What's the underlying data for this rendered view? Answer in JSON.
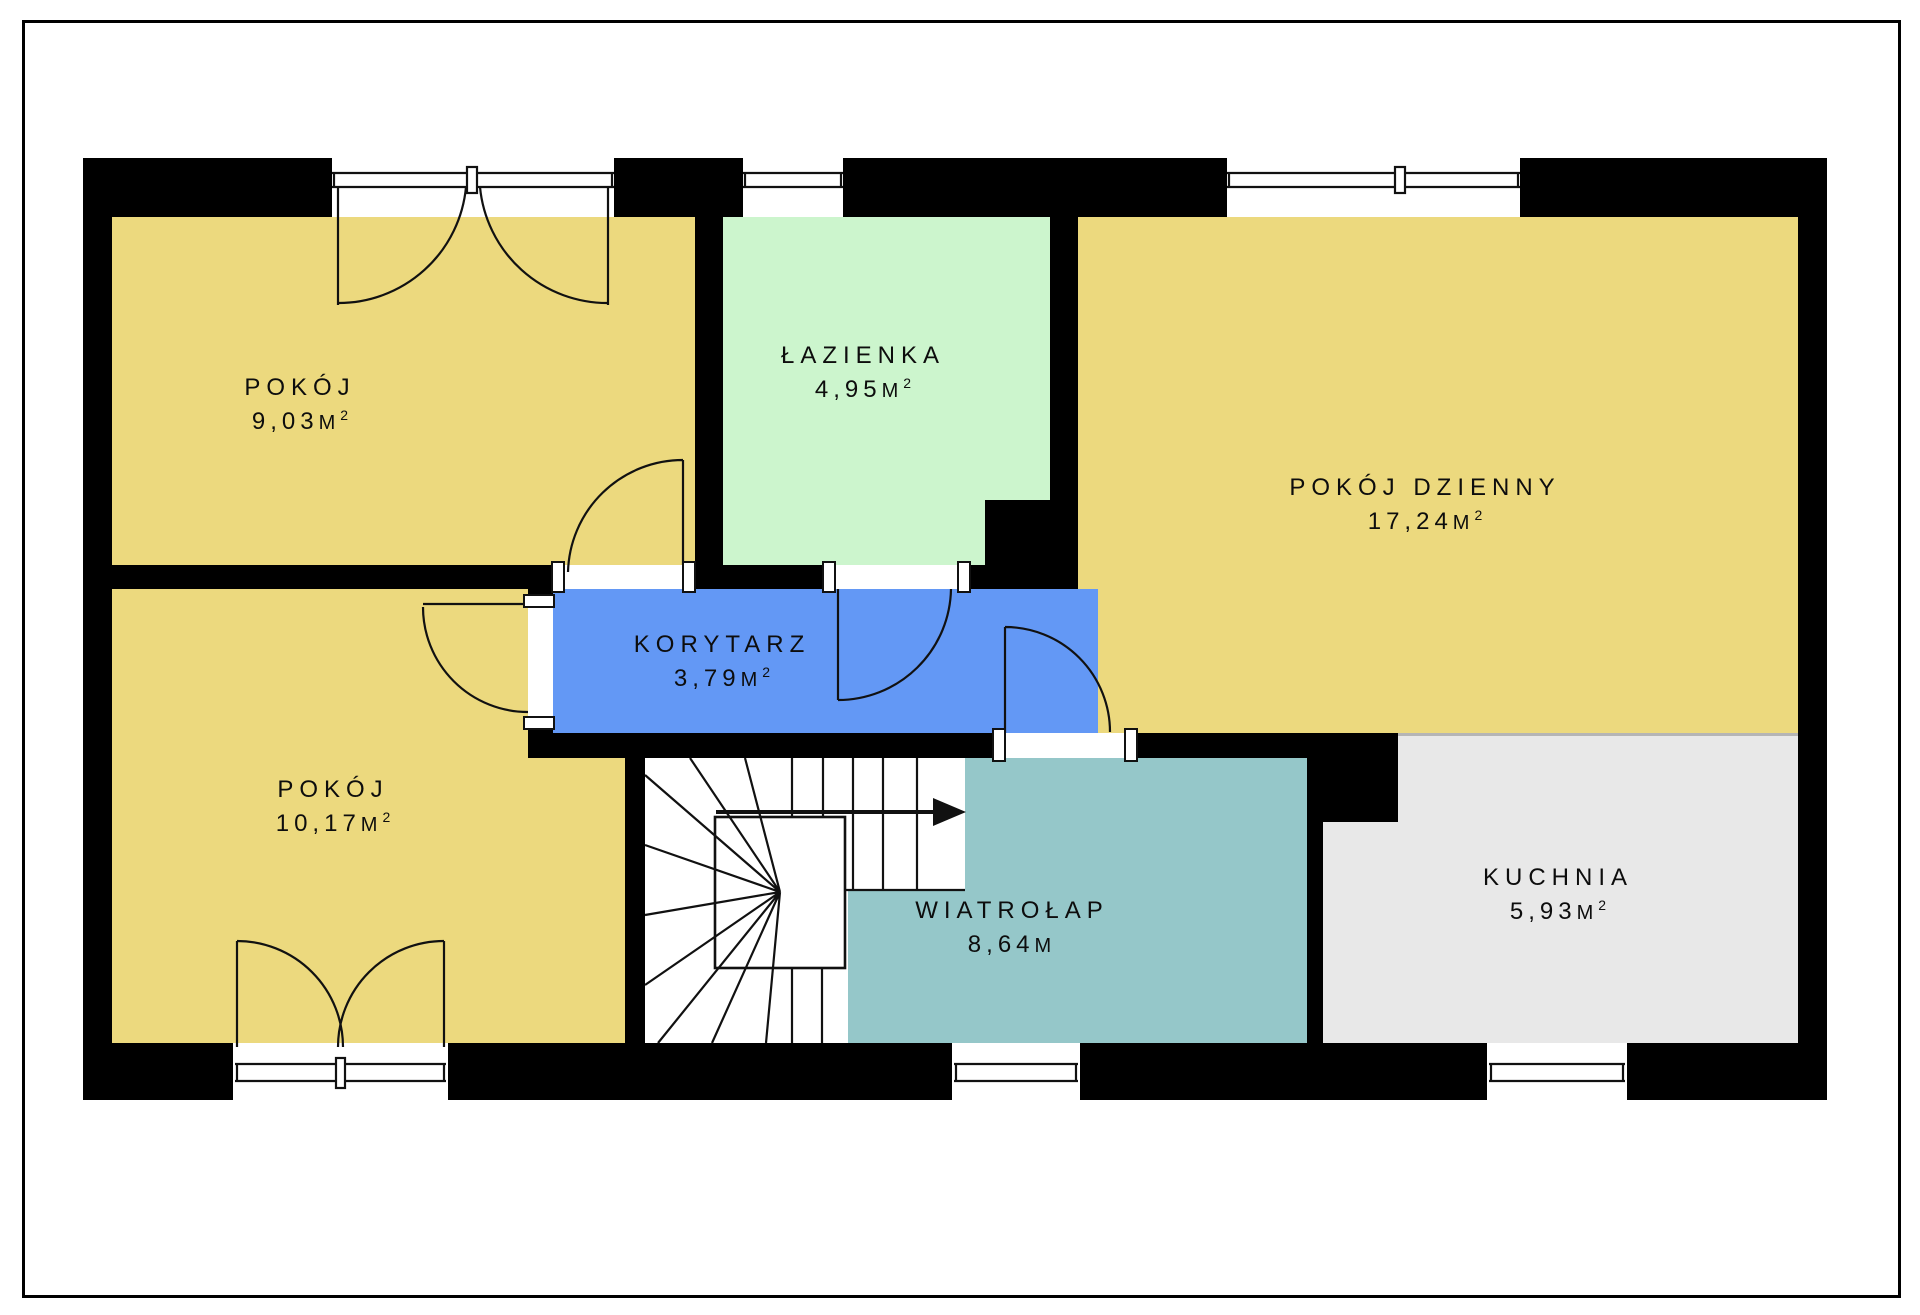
{
  "plan": {
    "type": "apartment floor plan",
    "palette": {
      "wall": "#000000",
      "background": "#ffffff",
      "room_yellow": "#ecd97e",
      "bathroom_green": "#ccf5cd",
      "corridor_blue": "#6398f5",
      "vestibule_teal": "#95c7c9",
      "kitchen_gray": "#e8e8e8",
      "open_boundary_line": "#b5b5b5"
    },
    "rooms": [
      {
        "key": "pokoj_top",
        "name": "POKÓJ",
        "area": "9,03",
        "unit": "M",
        "sup": "2",
        "color": "#ecd97e"
      },
      {
        "key": "lazienka",
        "name": "ŁAZIENKA",
        "area": "4,95",
        "unit": "M",
        "sup": "2",
        "color": "#ccf5cd"
      },
      {
        "key": "pokoj_dzienny",
        "name": "POKÓJ DZIENNY",
        "area": "17,24",
        "unit": "M",
        "sup": "2",
        "color": "#ecd97e"
      },
      {
        "key": "korytarz",
        "name": "KORYTARZ",
        "area": "3,79",
        "unit": "M",
        "sup": "2",
        "color": "#6398f5"
      },
      {
        "key": "pokoj_bottom",
        "name": "POKÓJ",
        "area": "10,17",
        "unit": "M",
        "sup": "2",
        "color": "#ecd97e"
      },
      {
        "key": "wiatrolap",
        "name": "WIATROŁAP",
        "area": "8,64",
        "unit": "M",
        "sup": "",
        "color": "#95c7c9"
      },
      {
        "key": "kuchnia",
        "name": "KUCHNIA",
        "area": "5,93",
        "unit": "M",
        "sup": "2",
        "color": "#e8e8e8"
      }
    ]
  }
}
